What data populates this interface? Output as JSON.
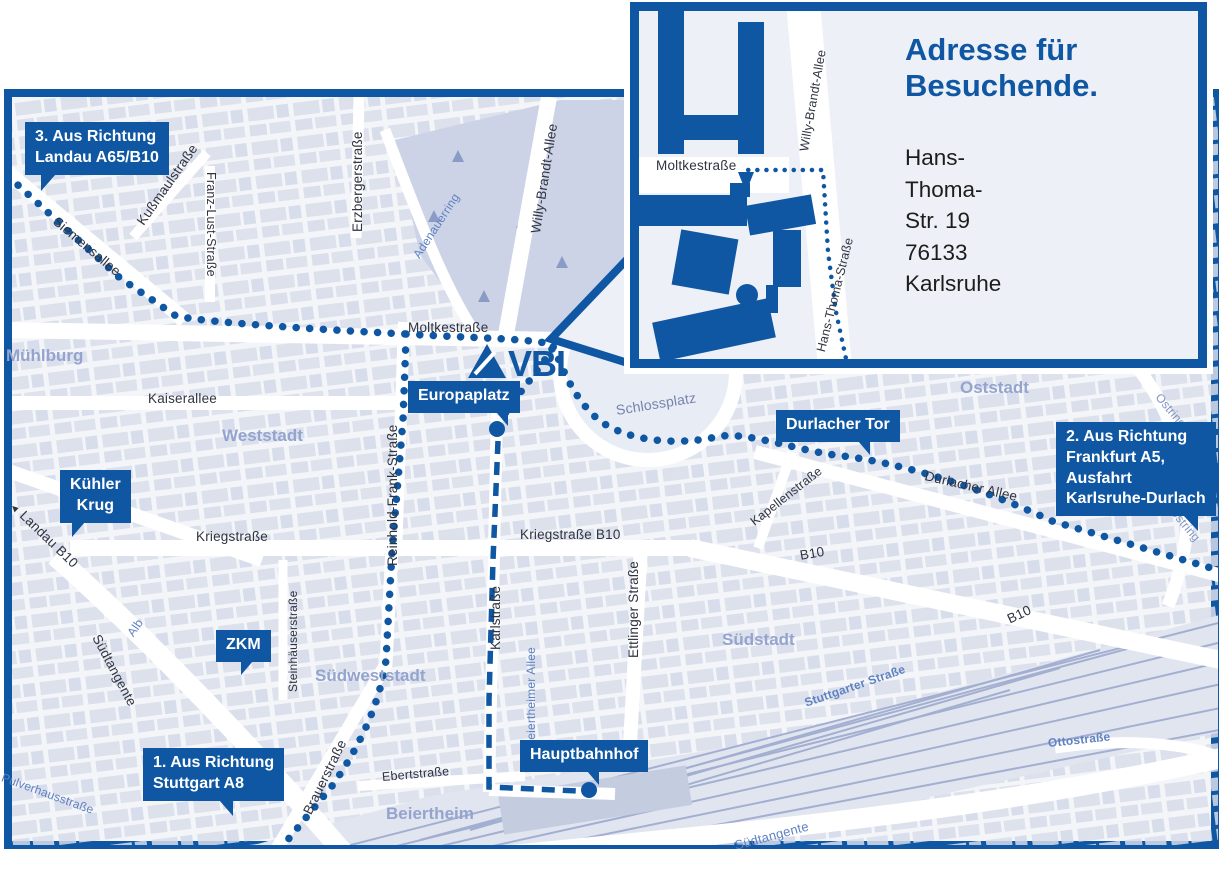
{
  "inset": {
    "heading_line1": "Adresse für",
    "heading_line2": "Besuchende.",
    "address_line1": "Hans-Thoma-Str. 19",
    "address_line2": "76133 Karlsruhe",
    "streets": {
      "moltkestrasse": "Moltkestraße",
      "willy_brandt_allee": "Willy-Brandt-Allee",
      "hans_thoma_strasse": "Hans-Thoma-Straße"
    }
  },
  "logo": {
    "text": "VBL"
  },
  "callouts": {
    "route3": {
      "line1": "3. Aus Richtung",
      "line2": "Landau A65/B10"
    },
    "route2": {
      "line1": "2. Aus Richtung",
      "line2": "Frankfurt A5,",
      "line3": "Ausfahrt",
      "line4": "Karlsruhe-Durlach"
    },
    "route1": {
      "line1": "1. Aus Richtung",
      "line2": "Stuttgart A8"
    },
    "europaplatz": {
      "line1": "Europaplatz"
    },
    "durlacher_tor": {
      "line1": "Durlacher Tor"
    },
    "kuehler_krug": {
      "line1": "Kühler",
      "line2": "Krug"
    },
    "zkm": {
      "line1": "ZKM"
    },
    "hauptbahnhof": {
      "line1": "Hauptbahnhof"
    }
  },
  "areas": {
    "muehlburg": "Mühlburg",
    "weststadt": "Weststadt",
    "oststadt": "Oststadt",
    "suedstadt": "Südstadt",
    "suedweststadt": "Südweststadt",
    "beiertheim": "Beiertheim"
  },
  "streets": {
    "moltkestrasse": "Moltkestraße",
    "kaiserallee": "Kaiserallee",
    "kriegstrasse": "Kriegstraße",
    "kriegstrasse_b10": "Kriegstraße B10",
    "durlacher_allee": "Durlacher Allee",
    "siemensallee": "Siemensallee",
    "kussmaulstrasse": "Kußmaulstraße",
    "franz_lust_strasse": "Franz-Lust-Straße",
    "erzbergerstrasse": "Erzbergerstraße",
    "willy_brandt_allee": "Willy-Brandt-Allee",
    "reinhold_frank_strasse": "Reinhold-Frank-Straße",
    "karlstrasse": "Karlstraße",
    "ettlinger_strasse": "Ettlinger Straße",
    "kapellenstrasse": "Kapellenstraße",
    "schlossplatz": "Schlossplatz",
    "adenauerring": "Adenauerring",
    "brauerstrasse": "Brauerstraße",
    "ebertstrasse": "Ebertstraße",
    "steinhaeuserstrasse": "Steinhäuserstraße",
    "beiertheimer_allee": "Beiertheimer Allee",
    "stuttgarter_strasse": "Stuttgarter Straße",
    "ottostrasse": "Ottostraße",
    "suedtangente": "Südtangente",
    "alb": "Alb",
    "ostring": "Ostring",
    "b10": "B10",
    "landau_b10": "Landau B10",
    "pulverhausstrasse": "Pulverhausstraße"
  },
  "icons": {
    "landau_arrow": "◄"
  },
  "colors": {
    "brand_blue": "#0f57a3",
    "map_background": "#f3f5f9",
    "block_fill": "#d8ddea",
    "area_label": "#94a4ce",
    "minor_street_label": "#5f82c2"
  }
}
